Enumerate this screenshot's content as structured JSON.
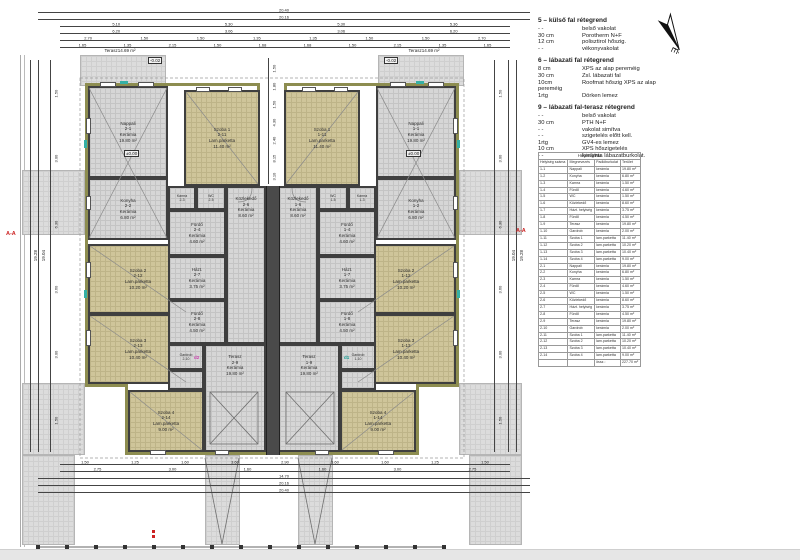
{
  "plan": {
    "rooms": {
      "l_nappali": [
        "Nappali",
        "2-1",
        "Kerámia",
        "19.80 m²"
      ],
      "l_konyha": [
        "Konyha",
        "2-2",
        "Kerámia",
        "6.80 m²"
      ],
      "l_kamra": [
        "Kamra",
        "2-3"
      ],
      "l_wc": [
        "WC",
        "2-5"
      ],
      "l_furdo1": [
        "Fürdő",
        "2-4",
        "Kerámia",
        "4.60 m²"
      ],
      "l_kozl": [
        "Közlekedő",
        "2-6",
        "Kerámia",
        "8.60 m²"
      ],
      "l_hazt": [
        "Házt.",
        "2-7",
        "Kerámia",
        "3.75 m²"
      ],
      "l_furdo2": [
        "Fürdő",
        "2-8",
        "Kerámia",
        "4.50 m²"
      ],
      "l_gardrob": [
        "Gardrob",
        "2-10"
      ],
      "l_terasz": [
        "Terasz",
        "2-9",
        "Kerámia",
        "19.80 m²"
      ],
      "l_szoba1": [
        "Szoba 1",
        "2-11",
        "Lam.parketta",
        "11.40 m²"
      ],
      "l_szoba2": [
        "Szoba 2",
        "2-12",
        "Lam.parketta",
        "10.20 m²"
      ],
      "l_szoba3": [
        "Szoba 3",
        "2-13",
        "Lam.parketta",
        "10.40 m²"
      ],
      "l_szoba4": [
        "Szoba 4",
        "2-14",
        "Lam.parketta",
        "9.00 m²"
      ],
      "r_nappali": [
        "Nappali",
        "1-1",
        "Kerámia",
        "19.80 m²"
      ],
      "r_konyha": [
        "Konyha",
        "1-2",
        "Kerámia",
        "6.80 m²"
      ],
      "r_kamra": [
        "Kamra",
        "1-3"
      ],
      "r_wc": [
        "WC",
        "1-5"
      ],
      "r_furdo1": [
        "Fürdő",
        "1-4",
        "Kerámia",
        "4.60 m²"
      ],
      "r_kozl": [
        "Közlekedő",
        "1-6",
        "Kerámia",
        "8.60 m²"
      ],
      "r_hazt": [
        "Házt.",
        "1-7",
        "Kerámia",
        "3.75 m²"
      ],
      "r_furdo2": [
        "Fürdő",
        "1-8",
        "Kerámia",
        "4.50 m²"
      ],
      "r_gardrob": [
        "Gardrob",
        "1-10"
      ],
      "r_terasz": [
        "Terasz",
        "1-9",
        "Kerámia",
        "19.80 m²"
      ],
      "r_szoba1": [
        "Szoba 1",
        "1-11",
        "Lam.parketta",
        "11.40 m²"
      ],
      "r_szoba2": [
        "Szoba 2",
        "1-12",
        "Lam.parketta",
        "10.20 m²"
      ],
      "r_szoba3": [
        "Szoba 3",
        "1-13",
        "Lam.parketta",
        "10.40 m²"
      ],
      "r_szoba4": [
        "Szoba 4",
        "1-14",
        "Lam.parketta",
        "9.00 m²"
      ]
    },
    "markers": {
      "section": "A-A",
      "level_zero": "±0.00",
      "level_terr": "-0.02",
      "terasz_out": [
        "Terasz",
        "14.69 m²"
      ],
      "d1": "d1",
      "d2": "d2"
    },
    "dims": {
      "top_r1": [
        "20.40"
      ],
      "top_r2": [
        "20.16"
      ],
      "top_r3": [
        "5.10",
        "5.30",
        "5.30",
        "5.36"
      ],
      "top_r4": [
        "6.20",
        "3.06",
        "3.06",
        "6.20"
      ],
      "top_r5": [
        "2.70",
        "1.50",
        "1.50",
        "1.35",
        "1.35",
        "1.50",
        "1.50",
        "2.70"
      ],
      "top_r6": [
        "1.65",
        "1.35",
        "2.15",
        "1.50",
        "1.68",
        "1.68",
        "1.50",
        "2.15",
        "1.35",
        "1.65"
      ],
      "bot_b1": [
        "1.50",
        "1.25",
        "1.60",
        "3.60",
        "2.90",
        "3.60",
        "1.60",
        "1.25",
        "1.50"
      ],
      "bot_b2": [
        "2.75",
        "3.00",
        "1.60",
        "1.60",
        "3.00",
        "2.75"
      ],
      "bot_b3": [
        "14.70"
      ],
      "bot_b4": [
        "20.16"
      ],
      "bot_b5": [
        "20.40"
      ],
      "left_total1": "19.28",
      "left_total2": "19.04",
      "left_segs": [
        "1.50",
        "3.00",
        "6.30",
        "3.60",
        "3.00",
        "1.50"
      ],
      "center_segs": [
        "1.50",
        "1.80",
        "1.50",
        "4.30",
        "2.40",
        "8.15",
        "3.10"
      ]
    }
  },
  "legend": {
    "north_label": "É",
    "sections": [
      {
        "title": "5 – külső fal rétegrend",
        "rows": [
          [
            "- -",
            "belső vakolat"
          ],
          [
            "30 cm",
            "Porotherm N+F"
          ],
          [
            "12 cm",
            "polisztirol hőszig."
          ],
          [
            "- -",
            "vékonyvakolat"
          ]
        ]
      },
      {
        "title": "6 – lábazati fal rétegrend",
        "rows": [
          [
            "8 cm",
            "XPS az alap pereméig"
          ],
          [
            "30 cm",
            "Zsl. lábazati fal"
          ],
          [
            "10cm",
            "Roofmat hőszig XPS az alap"
          ],
          [
            "pereméig",
            ""
          ],
          [
            "1rtg",
            "Dörken lemez"
          ]
        ]
      },
      {
        "title": "9 – lábazati fal-terasz rétegrend",
        "rows": [
          [
            "- -",
            "belső vakolat"
          ],
          [
            "30 cm",
            "PTH N+F"
          ],
          [
            "- -",
            "vakolat simítva"
          ],
          [
            "- -",
            "szigetelés előtt kell."
          ],
          [
            "1rtg",
            "GV4-es lemez"
          ],
          [
            "10 cm",
            "XPS hőszigetelés"
          ],
          [
            "- -",
            "kerámia lábazatburkolat."
          ]
        ]
      }
    ]
  },
  "schedule": {
    "caption_rows": [
      [
        "Helyiséglista"
      ]
    ],
    "header_rows": [
      [
        "Helyiség száma",
        "Megnevezés",
        "Padlóburkolat",
        "Terület"
      ]
    ],
    "rows": [
      [
        "1-1",
        "Nappali",
        "kerámia",
        "19.80 m²"
      ],
      [
        "1-2",
        "Konyha",
        "kerámia",
        "6.80 m²"
      ],
      [
        "1-3",
        "Kamra",
        "kerámia",
        "1.50 m²"
      ],
      [
        "1-4",
        "Fürdő",
        "kerámia",
        "4.60 m²"
      ],
      [
        "1-5",
        "WC",
        "kerámia",
        "1.50 m²"
      ],
      [
        "1-6",
        "Közlekedő",
        "kerámia",
        "8.60 m²"
      ],
      [
        "1-7",
        "Házt. helyiség",
        "kerámia",
        "3.75 m²"
      ],
      [
        "1-8",
        "Fürdő",
        "kerámia",
        "4.50 m²"
      ],
      [
        "1-9",
        "Terasz",
        "kerámia",
        "19.80 m²"
      ],
      [
        "1-10",
        "Gardrob",
        "kerámia",
        "2.00 m²"
      ],
      [
        "1-11",
        "Szoba 1",
        "lam.parketta",
        "11.40 m²"
      ],
      [
        "1-12",
        "Szoba 2",
        "lam.parketta",
        "10.20 m²"
      ],
      [
        "1-13",
        "Szoba 3",
        "lam.parketta",
        "10.40 m²"
      ],
      [
        "1-14",
        "Szoba 4",
        "lam.parketta",
        "9.00 m²"
      ],
      [
        "2-1",
        "Nappali",
        "kerámia",
        "19.80 m²"
      ],
      [
        "2-2",
        "Konyha",
        "kerámia",
        "6.80 m²"
      ],
      [
        "2-3",
        "Kamra",
        "kerámia",
        "1.50 m²"
      ],
      [
        "2-4",
        "Fürdő",
        "kerámia",
        "4.60 m²"
      ],
      [
        "2-5",
        "WC",
        "kerámia",
        "1.50 m²"
      ],
      [
        "2-6",
        "Közlekedő",
        "kerámia",
        "8.60 m²"
      ],
      [
        "2-7",
        "Házt. helyiség",
        "kerámia",
        "3.75 m²"
      ],
      [
        "2-8",
        "Fürdő",
        "kerámia",
        "4.50 m²"
      ],
      [
        "2-9",
        "Terasz",
        "kerámia",
        "19.80 m²"
      ],
      [
        "2-10",
        "Gardrob",
        "kerámia",
        "2.00 m²"
      ],
      [
        "2-11",
        "Szoba 1",
        "lam.parketta",
        "11.40 m²"
      ],
      [
        "2-12",
        "Szoba 2",
        "lam.parketta",
        "10.20 m²"
      ],
      [
        "2-13",
        "Szoba 3",
        "lam.parketta",
        "10.40 m²"
      ],
      [
        "2-14",
        "Szoba 4",
        "lam.parketta",
        "9.00 m²"
      ]
    ],
    "total_rows": [
      [
        "",
        "",
        "össz.:",
        "227.70 m²"
      ]
    ]
  }
}
